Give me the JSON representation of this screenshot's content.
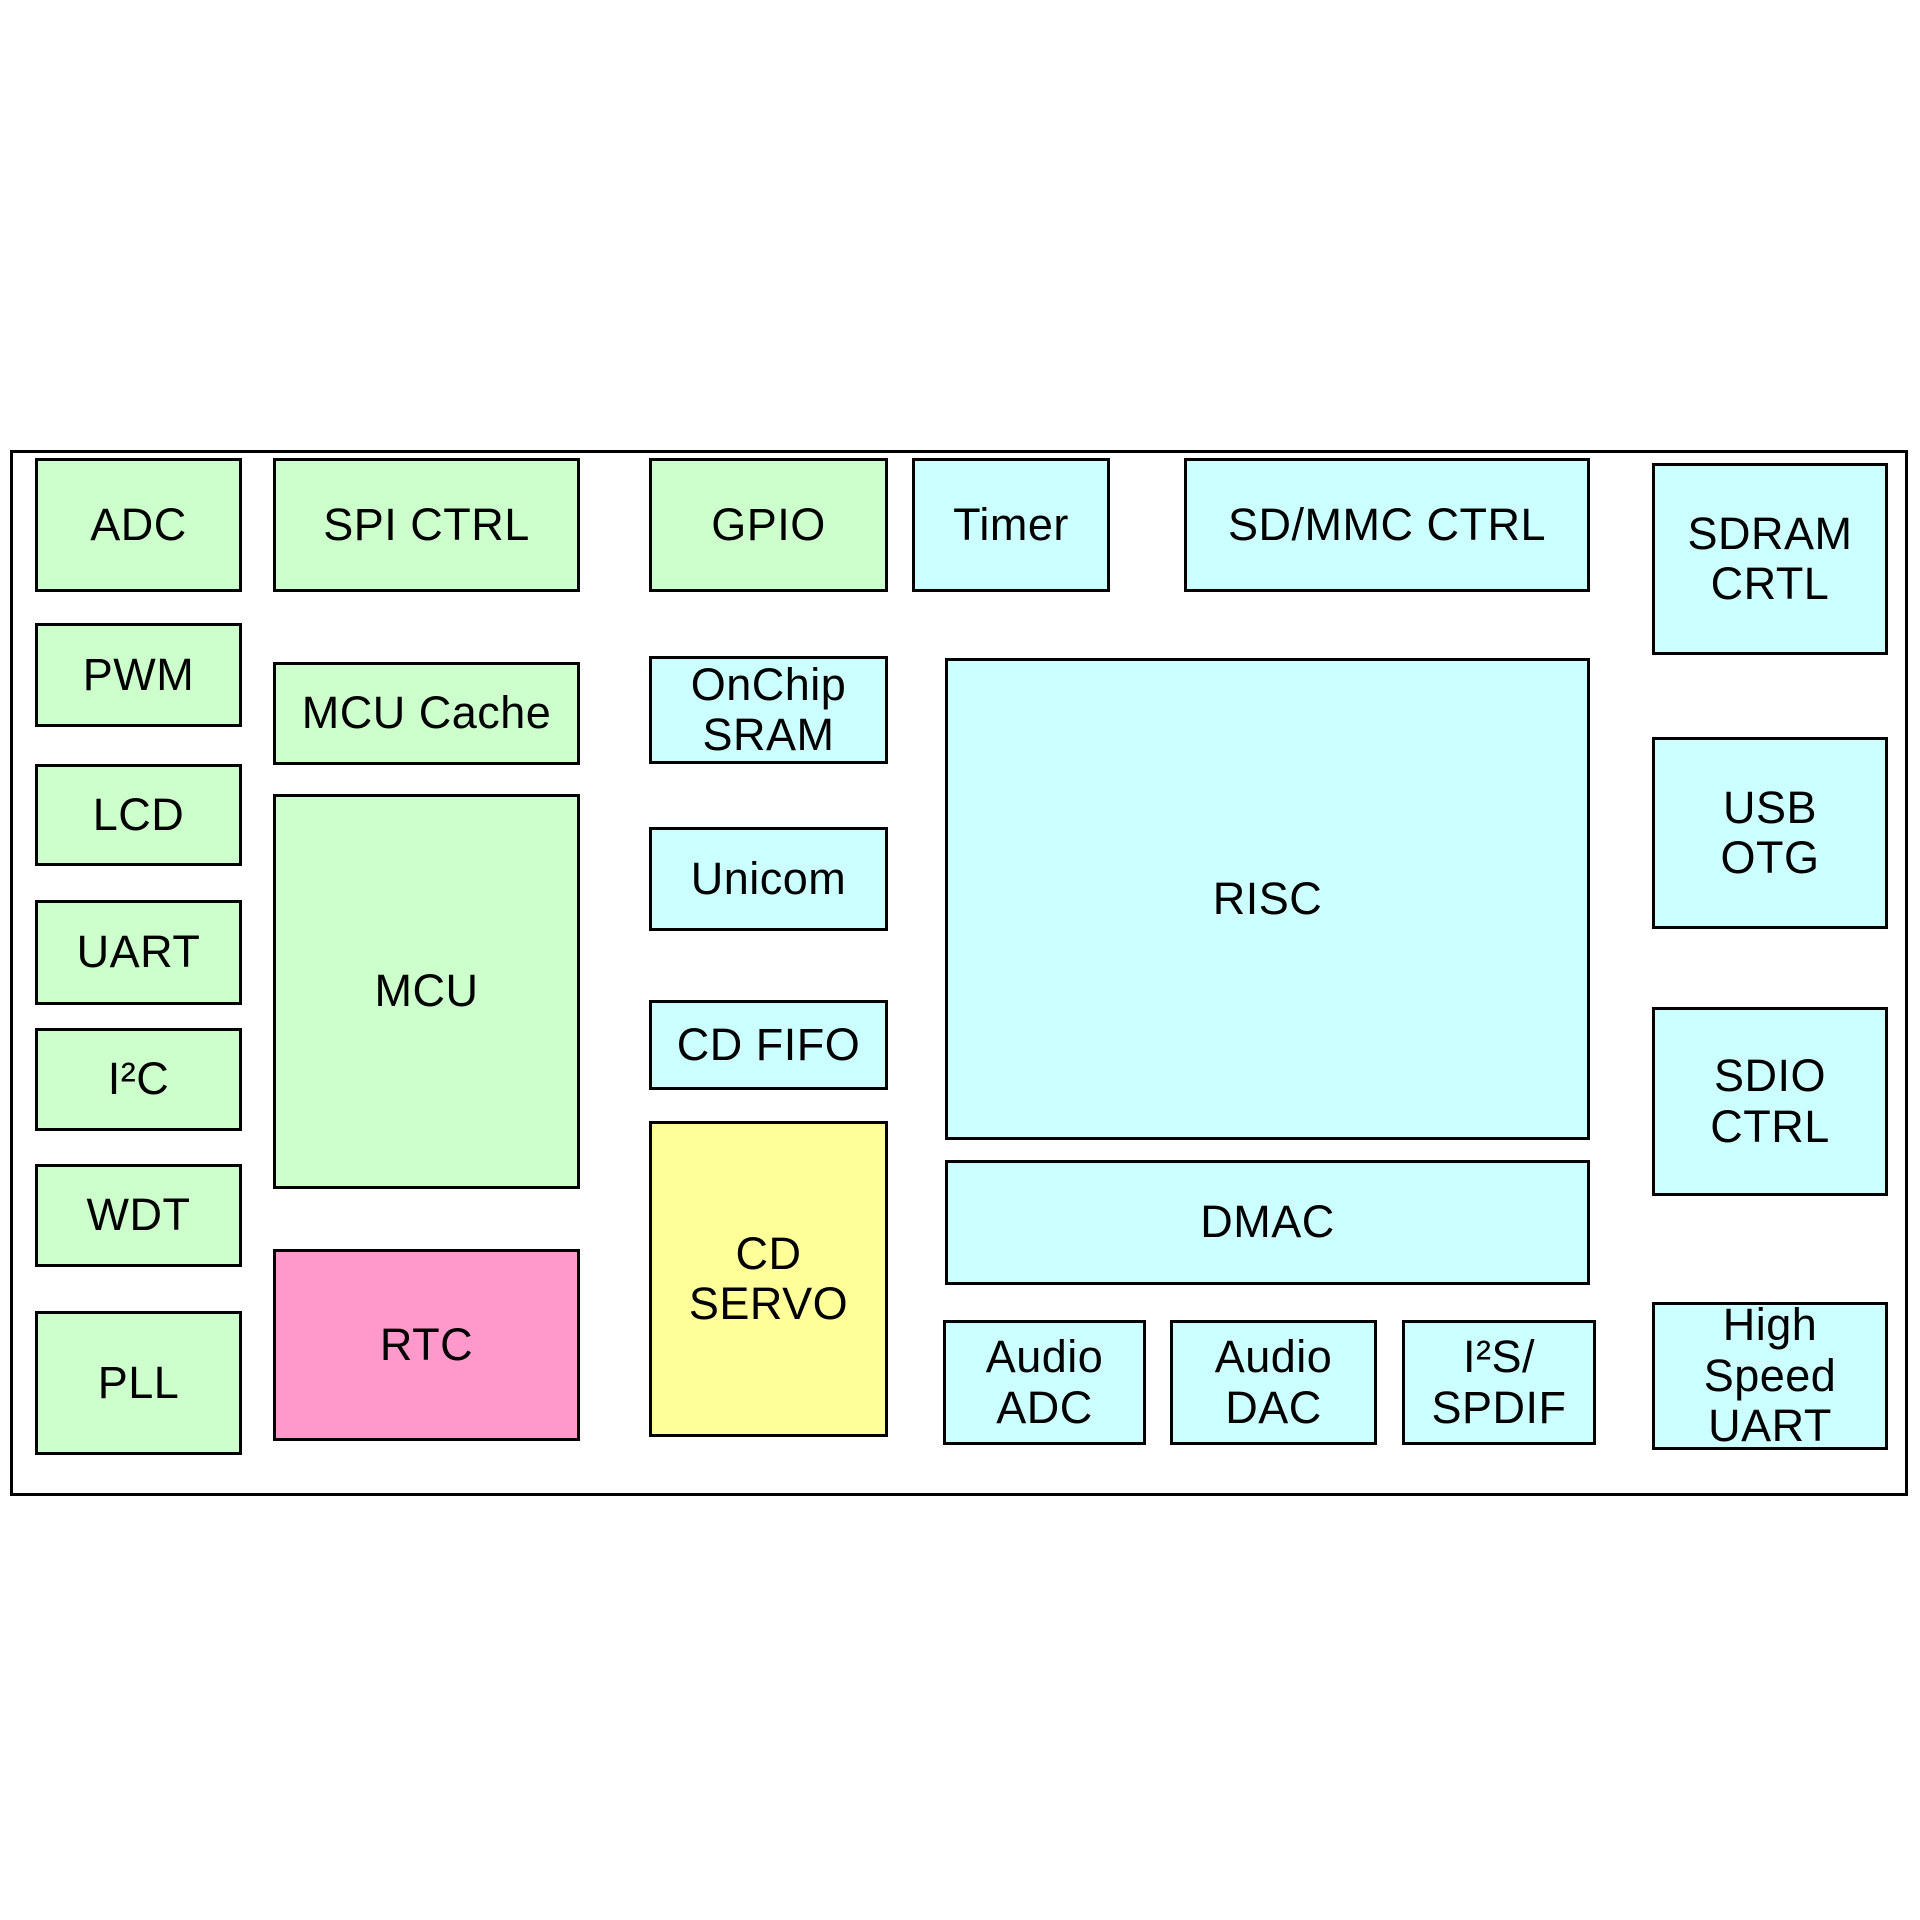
{
  "diagram": {
    "kind": "soc-block-diagram",
    "background": "#ffffff",
    "border_color": "#000000",
    "text_color": "#000000",
    "palette": {
      "green": "#ccffcc",
      "cyan": "#ccffff",
      "pink": "#ff99cc",
      "yellow": "#ffff99"
    },
    "boundary": {
      "x": 10,
      "y": 450,
      "w": 1898,
      "h": 1046
    },
    "blocks": [
      {
        "id": "adc",
        "lines": [
          "ADC"
        ],
        "color": "green",
        "x": 35,
        "y": 458,
        "w": 207,
        "h": 134
      },
      {
        "id": "spi-ctrl",
        "lines": [
          "SPI CTRL"
        ],
        "color": "green",
        "x": 273,
        "y": 458,
        "w": 307,
        "h": 134
      },
      {
        "id": "gpio",
        "lines": [
          "GPIO"
        ],
        "color": "green",
        "x": 649,
        "y": 458,
        "w": 239,
        "h": 134
      },
      {
        "id": "timer",
        "lines": [
          "Timer"
        ],
        "color": "cyan",
        "x": 912,
        "y": 458,
        "w": 198,
        "h": 134
      },
      {
        "id": "sd-mmc-ctrl",
        "lines": [
          "SD/MMC CTRL"
        ],
        "color": "cyan",
        "x": 1184,
        "y": 458,
        "w": 406,
        "h": 134
      },
      {
        "id": "sdram-crtl",
        "lines": [
          "SDRAM",
          "CRTL"
        ],
        "color": "cyan",
        "x": 1652,
        "y": 463,
        "w": 236,
        "h": 192
      },
      {
        "id": "pwm",
        "lines": [
          "PWM"
        ],
        "color": "green",
        "x": 35,
        "y": 623,
        "w": 207,
        "h": 104
      },
      {
        "id": "mcu-cache",
        "lines": [
          "MCU Cache"
        ],
        "color": "green",
        "x": 273,
        "y": 662,
        "w": 307,
        "h": 103
      },
      {
        "id": "onchip-sram",
        "lines": [
          "OnChip",
          "SRAM"
        ],
        "color": "cyan",
        "x": 649,
        "y": 656,
        "w": 239,
        "h": 108
      },
      {
        "id": "lcd",
        "lines": [
          "LCD"
        ],
        "color": "green",
        "x": 35,
        "y": 764,
        "w": 207,
        "h": 102
      },
      {
        "id": "mcu",
        "lines": [
          "MCU"
        ],
        "color": "green",
        "x": 273,
        "y": 794,
        "w": 307,
        "h": 395
      },
      {
        "id": "risc",
        "lines": [
          "RISC"
        ],
        "color": "cyan",
        "x": 945,
        "y": 658,
        "w": 645,
        "h": 482
      },
      {
        "id": "usb-otg",
        "lines": [
          "USB",
          "OTG"
        ],
        "color": "cyan",
        "x": 1652,
        "y": 737,
        "w": 236,
        "h": 192
      },
      {
        "id": "unicom",
        "lines": [
          "Unicom"
        ],
        "color": "cyan",
        "x": 649,
        "y": 827,
        "w": 239,
        "h": 104
      },
      {
        "id": "uart",
        "lines": [
          "UART"
        ],
        "color": "green",
        "x": 35,
        "y": 900,
        "w": 207,
        "h": 105
      },
      {
        "id": "i2c",
        "lines": [
          "I²C"
        ],
        "color": "green",
        "x": 35,
        "y": 1028,
        "w": 207,
        "h": 103
      },
      {
        "id": "cd-fifo",
        "lines": [
          "CD FIFO"
        ],
        "color": "cyan",
        "x": 649,
        "y": 1000,
        "w": 239,
        "h": 90
      },
      {
        "id": "sdio-ctrl",
        "lines": [
          "SDIO",
          "CTRL"
        ],
        "color": "cyan",
        "x": 1652,
        "y": 1007,
        "w": 236,
        "h": 189
      },
      {
        "id": "cd-servo",
        "lines": [
          "CD",
          "SERVO"
        ],
        "color": "yellow",
        "x": 649,
        "y": 1121,
        "w": 239,
        "h": 316
      },
      {
        "id": "wdt",
        "lines": [
          "WDT"
        ],
        "color": "green",
        "x": 35,
        "y": 1164,
        "w": 207,
        "h": 103
      },
      {
        "id": "dmac",
        "lines": [
          "DMAC"
        ],
        "color": "cyan",
        "x": 945,
        "y": 1160,
        "w": 645,
        "h": 125
      },
      {
        "id": "rtc",
        "lines": [
          "RTC"
        ],
        "color": "pink",
        "x": 273,
        "y": 1249,
        "w": 307,
        "h": 192
      },
      {
        "id": "pll",
        "lines": [
          "PLL"
        ],
        "color": "green",
        "x": 35,
        "y": 1311,
        "w": 207,
        "h": 144
      },
      {
        "id": "high-speed-uart",
        "lines": [
          "High",
          "Speed",
          "UART"
        ],
        "color": "cyan",
        "x": 1652,
        "y": 1302,
        "w": 236,
        "h": 148
      },
      {
        "id": "audio-adc",
        "lines": [
          "Audio",
          "ADC"
        ],
        "color": "cyan",
        "x": 943,
        "y": 1320,
        "w": 203,
        "h": 125
      },
      {
        "id": "audio-dac",
        "lines": [
          "Audio",
          "DAC"
        ],
        "color": "cyan",
        "x": 1170,
        "y": 1320,
        "w": 207,
        "h": 125
      },
      {
        "id": "i2s-spdif",
        "lines": [
          "I²S/",
          "SPDIF"
        ],
        "color": "cyan",
        "x": 1402,
        "y": 1320,
        "w": 194,
        "h": 125
      }
    ]
  }
}
